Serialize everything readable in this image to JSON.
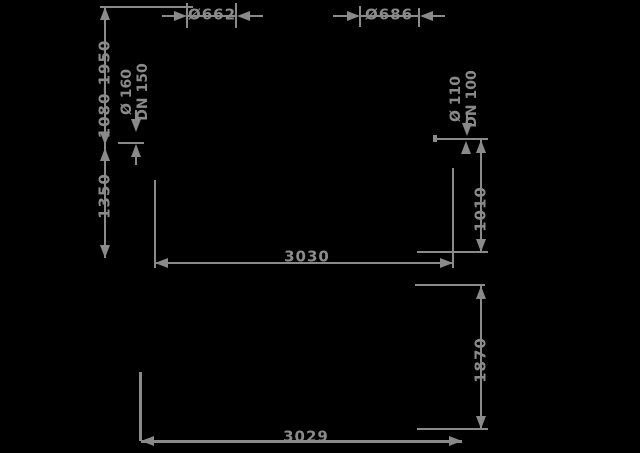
{
  "drawing": {
    "background_color": "#000000",
    "line_color": "#8a8a8a"
  },
  "labels": {
    "dia_left": "Ø662",
    "dia_right": "Ø686",
    "height_range": "1080-1950",
    "height_mid": "1350",
    "pipe_left_line1": "Ø 160",
    "pipe_left_line2": "DN 150",
    "pipe_right_line1": "Ø 110",
    "pipe_right_line2": "DN 100",
    "height_right": "1010",
    "width_upper": "3030",
    "height_lower": "1870",
    "width_lower": "3029"
  }
}
